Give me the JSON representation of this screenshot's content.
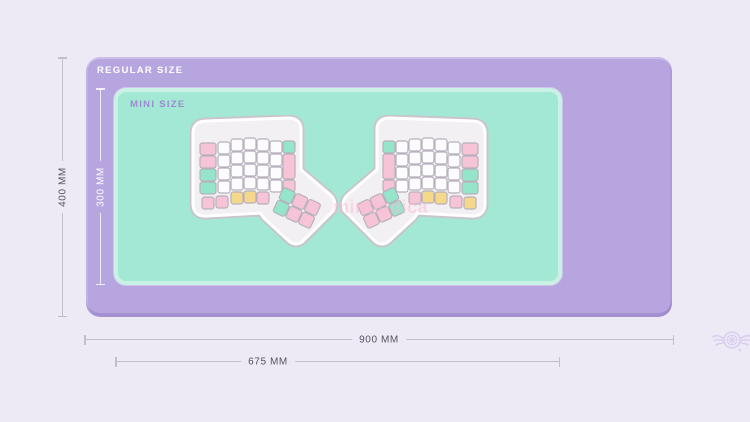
{
  "page": {
    "background": "#edeaf6"
  },
  "regular_mat": {
    "label": "REGULAR SIZE",
    "fill": "#b7a5e0",
    "width_label": "900 MM",
    "height_label": "400 MM"
  },
  "mini_mat": {
    "label": "MINI SIZE",
    "fill": "#a3e8d4",
    "border": "#c9f1e4",
    "label_color": "#9e8cd1",
    "width_label": "675 MM",
    "height_label": "300 MM"
  },
  "watermark": {
    "text": "mintlodica"
  },
  "logo": {
    "icon": "winged-circle-logo"
  },
  "dimension_style": {
    "line_color": "#c2bfca",
    "text_color": "#56535e",
    "inner_line_color": "#ffffff"
  },
  "keyboard": {
    "key_colors": {
      "pink": "#f7c3d6",
      "mint": "#94e5ca",
      "yellow": "#f6d88c",
      "white": "#fcfbfd"
    },
    "key_stroke": "#b7b1bc",
    "plate_fill": "#f2f0f3",
    "plate_halo": "#ffffff",
    "plate_stroke": "#c8c5cd",
    "halves": [
      {
        "side": "left",
        "outer_column": [
          "pink",
          "pink",
          "mint",
          "mint"
        ],
        "white_columns": 5,
        "white_rows": 4,
        "inner_column": [
          "mint",
          "pink",
          "pink"
        ],
        "bottom_row": [
          "pink",
          "pink",
          "yellow",
          "yellow",
          "pink"
        ],
        "thumb_cluster": [
          [
            "mint",
            "pink",
            "pink"
          ],
          [
            "mint",
            "pink",
            "pink"
          ]
        ]
      },
      {
        "side": "right",
        "outer_column": [
          "pink",
          "pink",
          "mint",
          "mint"
        ],
        "white_columns": 5,
        "white_rows": 4,
        "inner_column": [
          "mint",
          "pink",
          "pink"
        ],
        "bottom_row": [
          "yellow",
          "pink",
          "yellow",
          "yellow",
          "pink"
        ],
        "thumb_cluster": [
          [
            "mint",
            "pink",
            "pink"
          ],
          [
            "mint",
            "pink",
            "pink"
          ]
        ]
      }
    ]
  }
}
